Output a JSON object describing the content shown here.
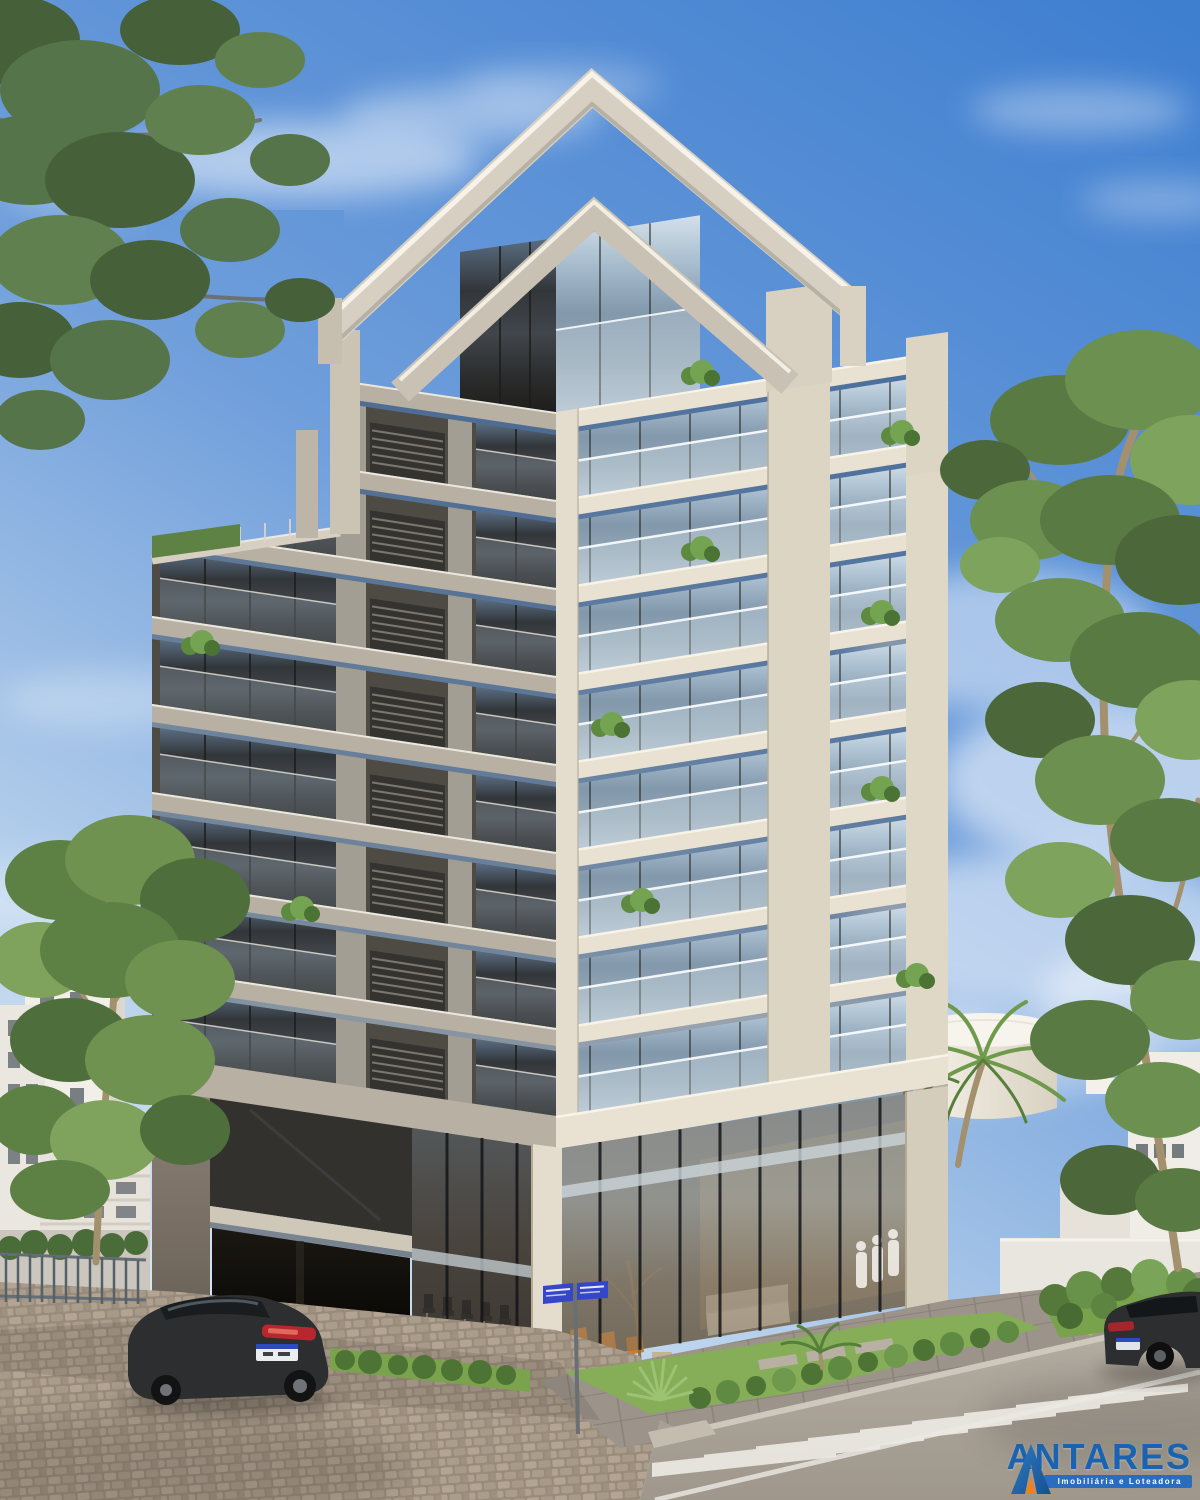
{
  "image": {
    "width": 1200,
    "height": 1500,
    "kind": "architectural-exterior-render"
  },
  "logo": {
    "name": "ANTARES",
    "tagline": "Imobiliária e Loteadora"
  },
  "palette": {
    "sky-top": "#3f7fd0",
    "sky-mid": "#6f9edb",
    "sky-horizon": "#e4eef6",
    "cloud": "#ffffff",
    "concrete-light": "#e9e2d2",
    "concrete-mid": "#b7b0a3",
    "concrete-dark": "#4e4b45",
    "pier-light": "#e4ddcd",
    "glass-dark": "#323639",
    "glass-light": "#a7bccd",
    "green-dark": "#4d7434",
    "green-mid": "#6c9050",
    "green-light": "#86a85e",
    "cobble": "#ab9d8c",
    "asphalt": "#a7a096",
    "sidewalk": "#9c948a",
    "marking-white": "#eceae3",
    "car-dark": "#2d2e2f",
    "taillight": "#b8272f",
    "sign-blue": "#3646c8",
    "logo-blue": "#1a63b0",
    "logo-orange": "#f07f24",
    "logo-ribbon": "#2a6cc0"
  },
  "scene": {
    "objects": [
      "sky",
      "clouds",
      "apartment-tower",
      "concrete-crown",
      "balconies",
      "balcony-plants",
      "glass-lobby",
      "entrance-canopy",
      "street-sign",
      "cobblestone-plaza",
      "asphalt-street",
      "sidewalk",
      "crosswalk",
      "lane-line",
      "parked-sedan",
      "parked-suv",
      "water-tank",
      "palm-tree",
      "background-buildings",
      "trees",
      "hedges",
      "agave-plants",
      "mannequins",
      "antares-logo"
    ]
  }
}
